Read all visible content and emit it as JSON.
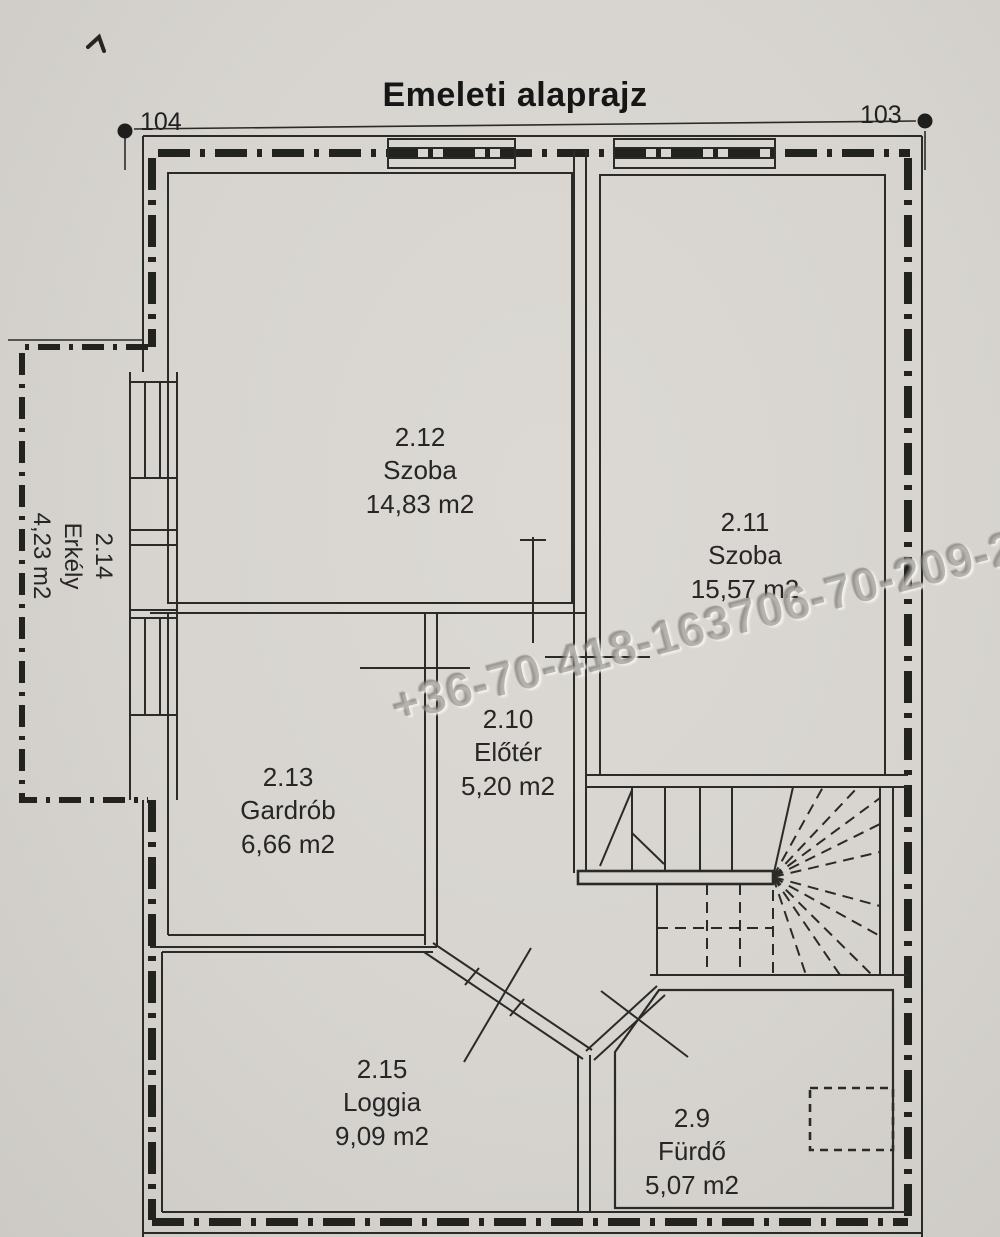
{
  "title": "Emeleti alaprajz",
  "markers": {
    "left": "104",
    "right": "103"
  },
  "watermark": "+36-70-418-163706-70-209-2",
  "rooms": [
    {
      "number": "2.12",
      "name": "Szoba",
      "area": "14,83 m2"
    },
    {
      "number": "2.11",
      "name": "Szoba",
      "area": "15,57 m2"
    },
    {
      "number": "2.10",
      "name": "Előtér",
      "area": "5,20 m2"
    },
    {
      "number": "2.13",
      "name": "Gardrób",
      "area": "6,66 m2"
    },
    {
      "number": "2.14",
      "name": "Erkély",
      "area": "4,23 m2"
    },
    {
      "number": "2.15",
      "name": "Loggia",
      "area": "9,09 m2"
    },
    {
      "number": "2.9",
      "name": "Fürdő",
      "area": "5,07 m2"
    }
  ],
  "colors": {
    "paper": "#d7d4cf",
    "ink": "#2a2a28",
    "watermark": "#7e7b76"
  }
}
